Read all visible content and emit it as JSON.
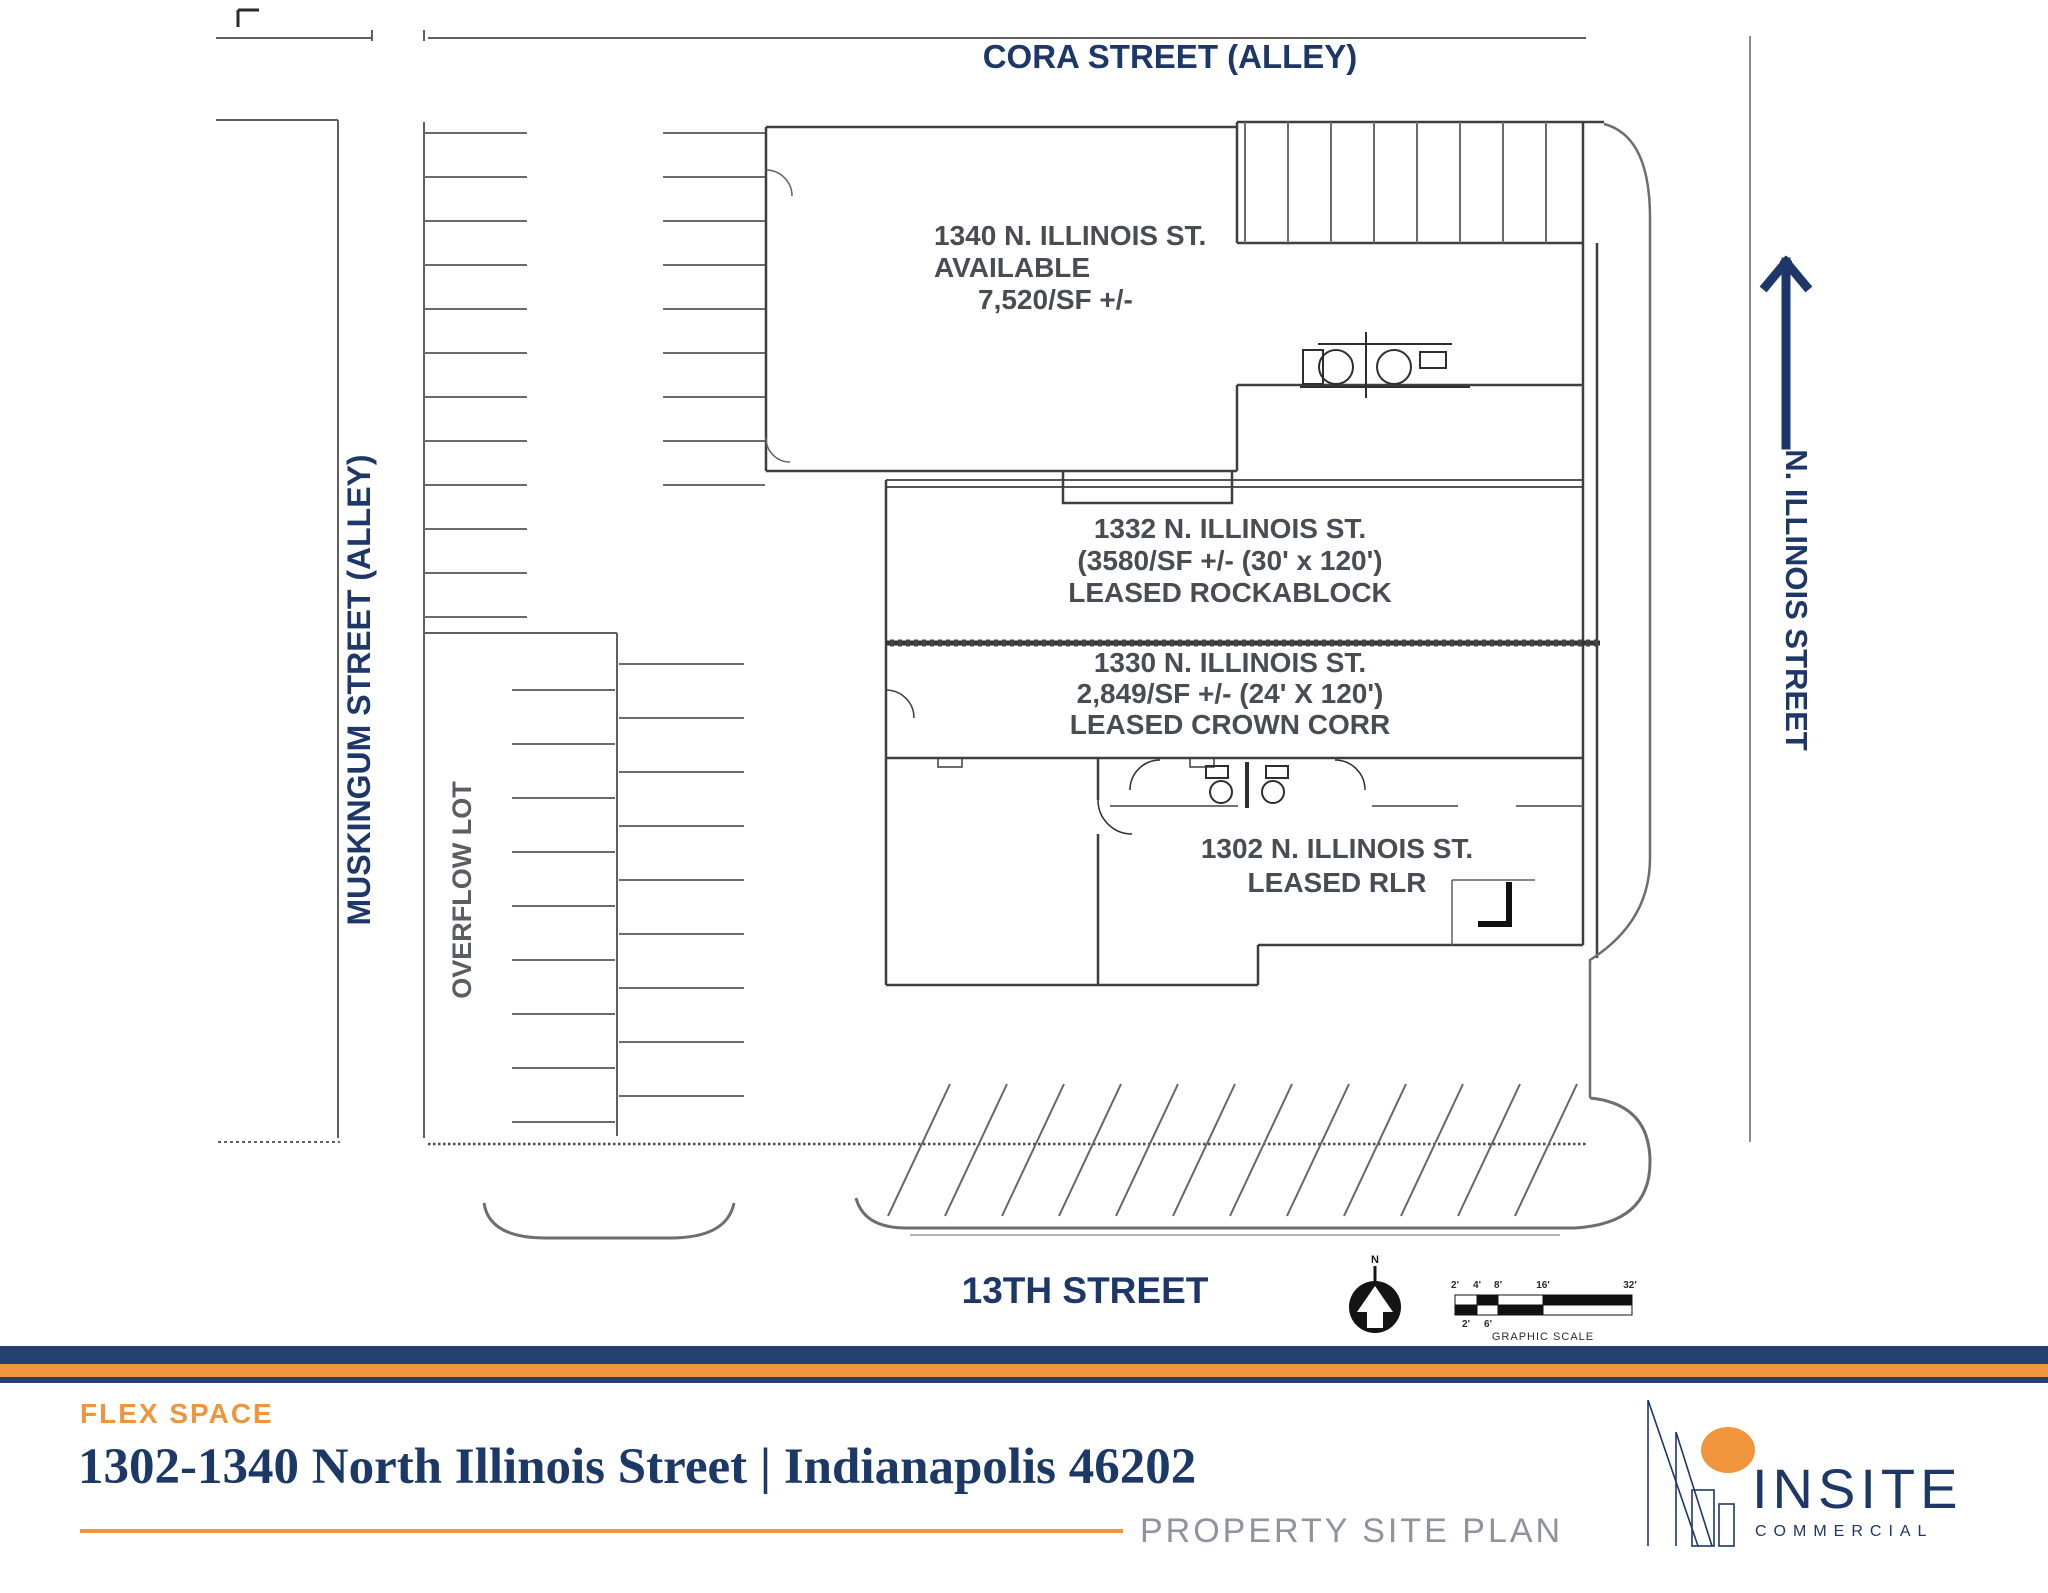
{
  "colors": {
    "navy": "#1d3768",
    "orange": "#f0953c",
    "plan_line": "#5f5f5f",
    "plan_text": "#474d52",
    "footer_gray": "#8e939c"
  },
  "plan": {
    "streets": {
      "top": "CORA STREET (ALLEY)",
      "left": "MUSKINGUM STREET (ALLEY)",
      "right": "N. ILLINOIS STREET",
      "bottom": "13TH STREET"
    },
    "overflow_label": "OVERFLOW LOT",
    "buildings": [
      {
        "name": "1340",
        "lines": [
          "1340 N. ILLINOIS ST.",
          "AVAILABLE",
          "7,520/SF +/-"
        ]
      },
      {
        "name": "1332",
        "lines": [
          "1332 N. ILLINOIS ST.",
          "(3580/SF +/- (30' x 120')",
          "LEASED ROCKABLOCK"
        ]
      },
      {
        "name": "1330",
        "lines": [
          "1330 N. ILLINOIS ST.",
          "2,849/SF +/- (24' X 120')",
          "LEASED CROWN CORR"
        ]
      },
      {
        "name": "1302",
        "lines": [
          "1302 N. ILLINOIS ST.",
          "LEASED RLR"
        ]
      }
    ],
    "compass": {
      "label": "N"
    },
    "scale_bar": {
      "ticks_top": [
        "2'",
        "4'",
        "8'",
        "16'",
        "32'"
      ],
      "ticks_bottom": [
        "2'",
        "6'"
      ],
      "caption": "GRAPHIC SCALE"
    }
  },
  "footer": {
    "category": "FLEX SPACE",
    "title": "1302-1340 North Illinois Street | Indianapolis 46202",
    "doc_type": "PROPERTY SITE PLAN",
    "brand": {
      "name": "INSITE",
      "tagline": "COMMERCIAL"
    }
  }
}
